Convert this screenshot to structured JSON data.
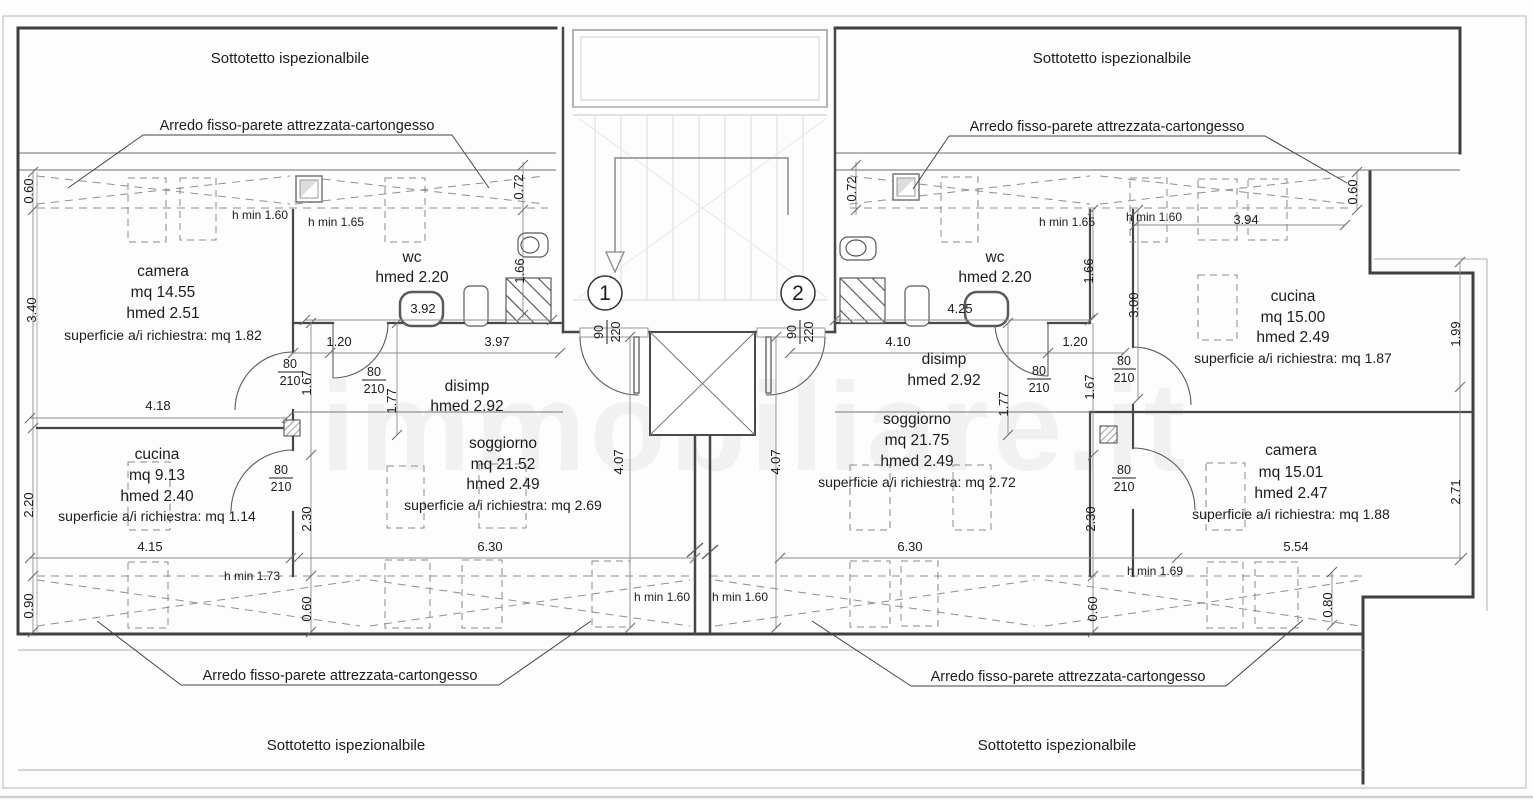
{
  "page": {
    "sottotetto_label": "Sottotetto ispezionalbile",
    "arredo_label": "Arredo fisso-parete attrezzata-cartongesso",
    "watermark": "immobiliare.it"
  },
  "units": {
    "one": "1",
    "two": "2"
  },
  "rooms": [
    {
      "id": "camera-1",
      "cx": 163,
      "ys": [
        276,
        297,
        318,
        340
      ],
      "lines": [
        "camera",
        "mq 14.55",
        "hmed 2.51",
        "superficie a/i richiestra: mq 1.82"
      ]
    },
    {
      "id": "wc-1",
      "cx": 412,
      "ys": [
        262,
        282
      ],
      "lines": [
        "wc",
        "hmed 2.20"
      ]
    },
    {
      "id": "disimp-1",
      "cx": 467,
      "ys": [
        391,
        411
      ],
      "lines": [
        "disimp",
        "hmed 2.92"
      ]
    },
    {
      "id": "soggiorno-1",
      "cx": 503,
      "ys": [
        448,
        469,
        489,
        510
      ],
      "lines": [
        "soggiorno",
        "mq 21.52",
        "hmed 2.49",
        "superficie a/i richiestra: mq 2.69"
      ]
    },
    {
      "id": "cucina-1",
      "cx": 157,
      "ys": [
        459,
        480,
        501,
        521
      ],
      "lines": [
        "cucina",
        "mq 9.13",
        "hmed 2.40",
        "superficie a/i richiestra: mq 1.14"
      ]
    },
    {
      "id": "wc-2",
      "cx": 995,
      "ys": [
        262,
        282
      ],
      "lines": [
        "wc",
        "hmed 2.20"
      ]
    },
    {
      "id": "disimp-2",
      "cx": 944,
      "ys": [
        364,
        385
      ],
      "lines": [
        "disimp",
        "hmed 2.92"
      ]
    },
    {
      "id": "soggiorno-2",
      "cx": 917,
      "ys": [
        424,
        445,
        466,
        487
      ],
      "lines": [
        "soggiorno",
        "mq 21.75",
        "hmed 2.49",
        "superficie a/i richiestra: mq 2.72"
      ]
    },
    {
      "id": "cucina-2",
      "cx": 1293,
      "ys": [
        301,
        322,
        342,
        363
      ],
      "lines": [
        "cucina",
        "mq 15.00",
        "hmed 2.49",
        "superficie a/i richiestra: mq 1.87"
      ]
    },
    {
      "id": "camera-2",
      "cx": 1291,
      "ys": [
        455,
        477,
        498,
        519
      ],
      "lines": [
        "camera",
        "mq 15.01",
        "hmed 2.47",
        "superficie a/i richiestra: mq 1.88"
      ]
    }
  ],
  "dims": [
    {
      "t": "0.60",
      "x": 33,
      "y": 191,
      "r": 1
    },
    {
      "t": "3.40",
      "x": 36,
      "y": 310,
      "r": 1
    },
    {
      "t": "2.20",
      "x": 33,
      "y": 505,
      "r": 1
    },
    {
      "t": "0.90",
      "x": 33,
      "y": 606,
      "r": 1
    },
    {
      "t": "4.18",
      "x": 158,
      "y": 410,
      "r": 0
    },
    {
      "t": "4.15",
      "x": 150,
      "y": 551,
      "r": 0
    },
    {
      "t": "h min 1.60",
      "x": 260,
      "y": 219,
      "r": 0
    },
    {
      "t": "h min 1.65",
      "x": 336,
      "y": 226,
      "r": 0
    },
    {
      "t": "3.92",
      "x": 423,
      "y": 313,
      "r": 0
    },
    {
      "t": "1.20",
      "x": 339,
      "y": 346,
      "r": 0
    },
    {
      "t": "3.97",
      "x": 497,
      "y": 346,
      "r": 0
    },
    {
      "t": "0.72",
      "x": 523,
      "y": 187,
      "r": 1
    },
    {
      "t": "1.66",
      "x": 524,
      "y": 271,
      "r": 1
    },
    {
      "t": "1.67",
      "x": 311,
      "y": 383,
      "r": 1
    },
    {
      "t": "1.77",
      "x": 396,
      "y": 401,
      "r": 1
    },
    {
      "t": "2.30",
      "x": 311,
      "y": 519,
      "r": 1
    },
    {
      "t": "0.60",
      "x": 311,
      "y": 609,
      "r": 1
    },
    {
      "t": "h min 1.73",
      "x": 252,
      "y": 580,
      "r": 0
    },
    {
      "t": "6.30",
      "x": 490,
      "y": 551,
      "r": 0
    },
    {
      "t": "4.07",
      "x": 623,
      "y": 462,
      "r": 1
    },
    {
      "t": "4.07",
      "x": 780,
      "y": 462,
      "r": 1
    },
    {
      "t": "h min 1.60",
      "x": 662,
      "y": 601,
      "r": 0
    },
    {
      "t": "h min 1.60",
      "x": 740,
      "y": 601,
      "r": 0
    },
    {
      "t": "6.30",
      "x": 910,
      "y": 551,
      "r": 0
    },
    {
      "t": "0.72",
      "x": 856,
      "y": 189,
      "r": 1
    },
    {
      "t": "h min 1.65",
      "x": 1067,
      "y": 226,
      "r": 0
    },
    {
      "t": "h min 1.60",
      "x": 1154,
      "y": 221,
      "r": 0
    },
    {
      "t": "3.94",
      "x": 1246,
      "y": 224,
      "r": 0
    },
    {
      "t": "0.60",
      "x": 1357,
      "y": 192,
      "r": 1
    },
    {
      "t": "4.25",
      "x": 960,
      "y": 313,
      "r": 0
    },
    {
      "t": "1.66",
      "x": 1093,
      "y": 271,
      "r": 1
    },
    {
      "t": "3.00",
      "x": 1138,
      "y": 305,
      "r": 1
    },
    {
      "t": "4.10",
      "x": 898,
      "y": 346,
      "r": 0
    },
    {
      "t": "1.20",
      "x": 1075,
      "y": 346,
      "r": 0
    },
    {
      "t": "1.67",
      "x": 1094,
      "y": 387,
      "r": 1
    },
    {
      "t": "1.77",
      "x": 1008,
      "y": 404,
      "r": 1
    },
    {
      "t": "1.99",
      "x": 1460,
      "y": 334,
      "r": 1
    },
    {
      "t": "2.30",
      "x": 1095,
      "y": 519,
      "r": 1
    },
    {
      "t": "0.60",
      "x": 1097,
      "y": 609,
      "r": 1
    },
    {
      "t": "2.71",
      "x": 1460,
      "y": 492,
      "r": 1
    },
    {
      "t": "5.54",
      "x": 1296,
      "y": 551,
      "r": 0
    },
    {
      "t": "h min 1.69",
      "x": 1155,
      "y": 575,
      "r": 0
    },
    {
      "t": "0.80",
      "x": 1332,
      "y": 605,
      "r": 1
    }
  ],
  "fractions": [
    {
      "top": "80",
      "bot": "210",
      "x": 290,
      "y": 372,
      "r": 0
    },
    {
      "top": "80",
      "bot": "210",
      "x": 374,
      "y": 380,
      "r": 0
    },
    {
      "top": "80",
      "bot": "210",
      "x": 281,
      "y": 478,
      "r": 0
    },
    {
      "top": "90",
      "bot": "220",
      "x": 607,
      "y": 332,
      "r": 1
    },
    {
      "top": "90",
      "bot": "220",
      "x": 800,
      "y": 332,
      "r": 1
    },
    {
      "top": "80",
      "bot": "210",
      "x": 1039,
      "y": 379,
      "r": 0
    },
    {
      "top": "80",
      "bot": "210",
      "x": 1124,
      "y": 369,
      "r": 0
    },
    {
      "top": "80",
      "bot": "210",
      "x": 1124,
      "y": 478,
      "r": 0
    }
  ],
  "wardrobes": [
    [
      128,
      178,
      38,
      64
    ],
    [
      180,
      178,
      36,
      62
    ],
    [
      385,
      178,
      40,
      64
    ],
    [
      941,
      177,
      37,
      65
    ],
    [
      1130,
      178,
      37,
      64
    ],
    [
      1198,
      179,
      39,
      61
    ],
    [
      1248,
      179,
      39,
      61
    ],
    [
      128,
      462,
      42,
      68
    ],
    [
      387,
      466,
      37,
      62
    ],
    [
      479,
      464,
      47,
      64
    ],
    [
      850,
      465,
      40,
      65
    ],
    [
      953,
      465,
      38,
      65
    ],
    [
      1198,
      275,
      39,
      65
    ],
    [
      1206,
      463,
      39,
      67
    ],
    [
      128,
      562,
      40,
      66
    ],
    [
      385,
      560,
      45,
      68
    ],
    [
      462,
      560,
      40,
      68
    ],
    [
      592,
      561,
      38,
      66
    ],
    [
      850,
      561,
      40,
      66
    ],
    [
      901,
      561,
      37,
      65
    ],
    [
      1207,
      562,
      36,
      66
    ],
    [
      1255,
      562,
      43,
      66
    ]
  ]
}
